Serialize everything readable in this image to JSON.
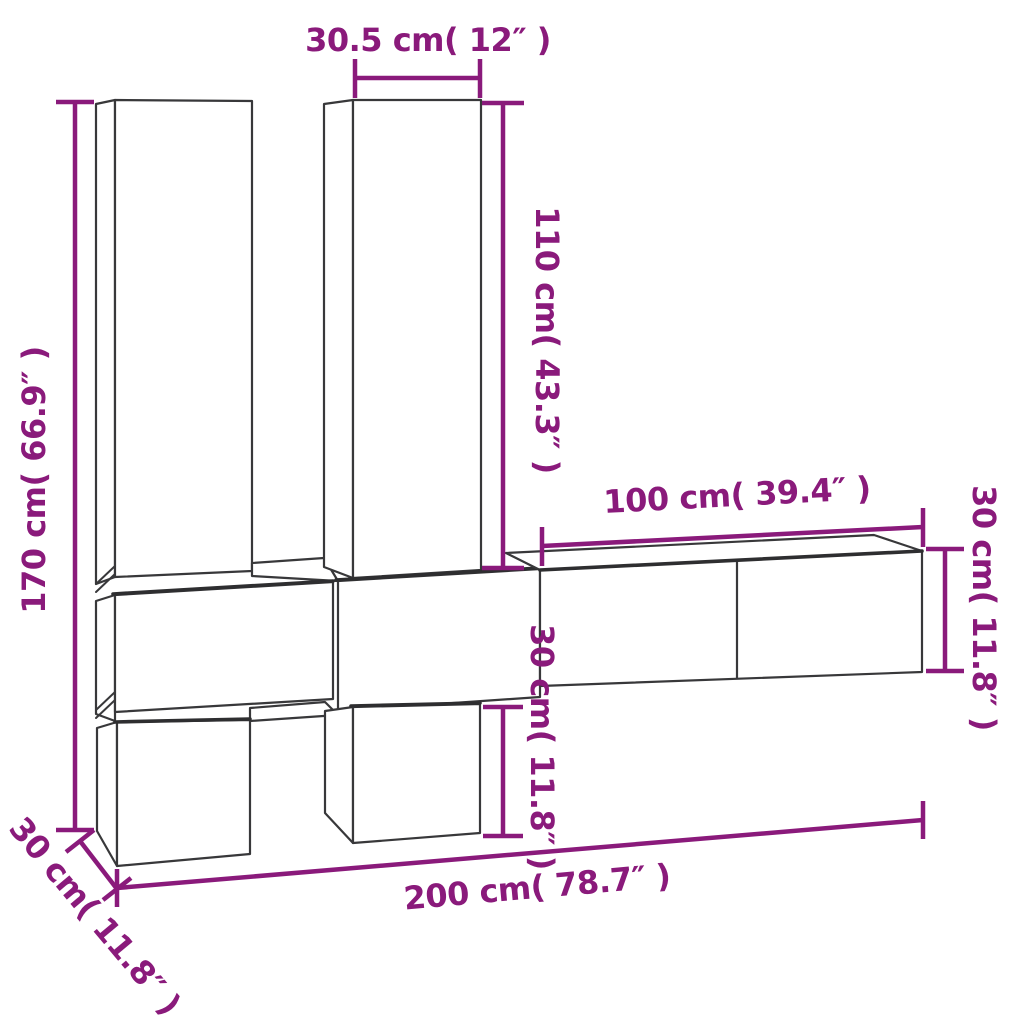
{
  "diagram": {
    "title": "wall-mounted-tv-cabinet-set-dimension-diagram",
    "colors": {
      "dimension_accent": "#8A1A7B",
      "outline": "#38383a",
      "background": "#ffffff"
    },
    "labels": {
      "top_width": "30.5 cm( 12″ )",
      "left_height": "170 cm( 66.9″ )",
      "middle_height": "110 cm( 43.3″ )",
      "shelf_width": "100 cm( 39.4″ )",
      "shelf_height": "30 cm( 11.8″ )",
      "lower_height": "30 cm( 11.8″ )",
      "total_width": "200 cm( 78.7″ )",
      "depth": "30 cm( 11.8″ )"
    },
    "measurements": [
      {
        "name": "tall-cabinet-width",
        "cm": 30.5,
        "inches": 12,
        "orientation": "horizontal"
      },
      {
        "name": "total-height",
        "cm": 170,
        "inches": 66.9,
        "orientation": "vertical"
      },
      {
        "name": "tall-cabinet-height",
        "cm": 110,
        "inches": 43.3,
        "orientation": "vertical"
      },
      {
        "name": "wall-shelf-width",
        "cm": 100,
        "inches": 39.4,
        "orientation": "horizontal"
      },
      {
        "name": "wall-shelf-height",
        "cm": 30,
        "inches": 11.8,
        "orientation": "vertical"
      },
      {
        "name": "lower-cabinet-height",
        "cm": 30,
        "inches": 11.8,
        "orientation": "vertical"
      },
      {
        "name": "total-width",
        "cm": 200,
        "inches": 78.7,
        "orientation": "horizontal"
      },
      {
        "name": "cabinet-depth",
        "cm": 30,
        "inches": 11.8,
        "orientation": "diagonal"
      }
    ]
  }
}
